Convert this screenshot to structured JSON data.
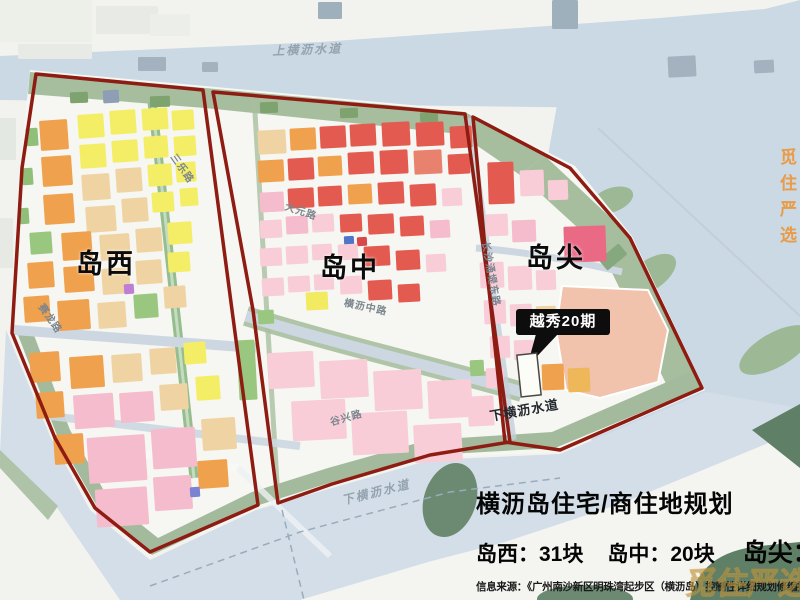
{
  "title_block": {
    "title": "横沥岛住宅/商住地规划",
    "stats": [
      "岛西：31块",
      "岛中：20块",
      "岛尖：3块"
    ],
    "source": "信息来源：《广州南沙新区明珠湾起步区（横沥岛）控制性详细规划修编批前公示》"
  },
  "callout": {
    "label": "越秀20期"
  },
  "watermarks": {
    "right": "觅住严选",
    "corner": "觅住严选"
  },
  "map_labels": [
    {
      "t": "岛西",
      "x": 76,
      "y": 242,
      "r": 0,
      "cls": "region"
    },
    {
      "t": "岛中",
      "x": 320,
      "y": 246,
      "r": 0,
      "cls": "region"
    },
    {
      "t": "岛尖",
      "x": 526,
      "y": 236,
      "r": 0,
      "cls": "region"
    },
    {
      "t": "上横沥水道",
      "x": 272,
      "y": 42,
      "r": -2,
      "cls": "water"
    },
    {
      "t": "下横沥水道",
      "x": 340,
      "y": 492,
      "r": -14,
      "cls": "water"
    },
    {
      "t": "下横沥水道",
      "x": 488,
      "y": 406,
      "r": -10,
      "cls": "water-dark"
    },
    {
      "t": "三乐路",
      "x": 180,
      "y": 150,
      "r": 55,
      "cls": "road"
    },
    {
      "t": "大元路",
      "x": 288,
      "y": 198,
      "r": 18,
      "cls": "road"
    },
    {
      "t": "横沥中路",
      "x": 346,
      "y": 294,
      "r": 12,
      "cls": "road"
    },
    {
      "t": "赛龙路",
      "x": 48,
      "y": 300,
      "r": 55,
      "cls": "road"
    },
    {
      "t": "谷兴路",
      "x": 328,
      "y": 414,
      "r": -16,
      "cls": "road"
    },
    {
      "t": "长沙涌堤东路",
      "x": 494,
      "y": 240,
      "r": 80,
      "cls": "road"
    }
  ],
  "boundary_color": "#8e1c12",
  "parcels": [
    [
      0,
      0,
      92,
      42,
      "#edefe9",
      0
    ],
    [
      96,
      6,
      62,
      28,
      "#e8ebe5",
      0
    ],
    [
      18,
      44,
      74,
      15,
      "#e8ebe5",
      0
    ],
    [
      150,
      14,
      40,
      22,
      "#eceee9",
      0
    ],
    [
      138,
      57,
      28,
      14,
      "#a4b2bf",
      0
    ],
    [
      202,
      62,
      16,
      10,
      "#a4b2bf",
      0
    ],
    [
      318,
      2,
      24,
      17,
      "#9fb0bd",
      0
    ],
    [
      552,
      0,
      26,
      29,
      "#9fb0bd",
      0
    ],
    [
      668,
      56,
      28,
      21,
      "#a4b2bf",
      -3
    ],
    [
      754,
      60,
      20,
      13,
      "#a4b2bf",
      -3
    ],
    [
      103,
      90,
      16,
      13,
      "#8e9fb5",
      -3
    ],
    [
      0,
      118,
      16,
      42,
      "#e4e8e2",
      0
    ],
    [
      0,
      218,
      13,
      50,
      "#e7eae4",
      0
    ],
    [
      70,
      92,
      18,
      11,
      "#7fa36f",
      -2
    ],
    [
      150,
      96,
      20,
      11,
      "#7fa36f",
      -2
    ],
    [
      260,
      102,
      18,
      11,
      "#7fa36f",
      -2
    ],
    [
      340,
      108,
      18,
      10,
      "#7fa36f",
      -2
    ],
    [
      420,
      112,
      18,
      10,
      "#7fa36f",
      -2
    ],
    [
      600,
      250,
      26,
      14,
      "#86a87e",
      -40
    ],
    [
      26,
      128,
      12,
      18,
      "#8fbf78",
      -4
    ],
    [
      22,
      168,
      11,
      17,
      "#8fbf78",
      -4
    ],
    [
      19,
      208,
      10,
      16,
      "#8fbf78",
      -4
    ],
    [
      30,
      232,
      22,
      22,
      "#9ac77f",
      -4
    ],
    [
      40,
      120,
      28,
      30,
      "#efa14d",
      -4
    ],
    [
      42,
      156,
      30,
      30,
      "#efa14d",
      -4
    ],
    [
      44,
      194,
      30,
      30,
      "#efa14d",
      -4
    ],
    [
      28,
      262,
      26,
      26,
      "#efa14d",
      -4
    ],
    [
      24,
      296,
      26,
      26,
      "#efa14d",
      -4
    ],
    [
      78,
      114,
      26,
      24,
      "#f4ee66",
      -4
    ],
    [
      110,
      110,
      26,
      24,
      "#f4ee66",
      -4
    ],
    [
      142,
      108,
      26,
      22,
      "#f4ee66",
      -4
    ],
    [
      172,
      110,
      22,
      20,
      "#f4ee66",
      -4
    ],
    [
      80,
      144,
      26,
      24,
      "#f4ee66",
      -4
    ],
    [
      112,
      140,
      26,
      22,
      "#f4ee66",
      -4
    ],
    [
      144,
      136,
      24,
      22,
      "#f4ee66",
      -4
    ],
    [
      174,
      136,
      22,
      20,
      "#f4ee66",
      -4
    ],
    [
      148,
      164,
      24,
      22,
      "#f4ee66",
      -4
    ],
    [
      176,
      162,
      20,
      20,
      "#f4ee66",
      -4
    ],
    [
      152,
      192,
      22,
      20,
      "#f4ee66",
      -4
    ],
    [
      180,
      188,
      18,
      18,
      "#f4ee66",
      -4
    ],
    [
      82,
      174,
      28,
      26,
      "#f0d3a2",
      -4
    ],
    [
      116,
      168,
      26,
      24,
      "#f0d3a2",
      -4
    ],
    [
      86,
      206,
      30,
      26,
      "#f0d3a2",
      -4
    ],
    [
      122,
      198,
      26,
      24,
      "#f0d3a2",
      -4
    ],
    [
      62,
      232,
      30,
      28,
      "#efa14d",
      -4
    ],
    [
      100,
      234,
      30,
      26,
      "#f0d3a2",
      -4
    ],
    [
      136,
      228,
      26,
      24,
      "#f0d3a2",
      -4
    ],
    [
      168,
      222,
      24,
      22,
      "#f4ee66",
      -4
    ],
    [
      64,
      266,
      30,
      26,
      "#efa14d",
      -4
    ],
    [
      102,
      268,
      28,
      26,
      "#f0d3a2",
      -4
    ],
    [
      136,
      260,
      26,
      24,
      "#f0d3a2",
      -4
    ],
    [
      168,
      252,
      22,
      20,
      "#f4ee66",
      -4
    ],
    [
      58,
      300,
      32,
      30,
      "#efa14d",
      -4
    ],
    [
      98,
      302,
      28,
      26,
      "#f0d3a2",
      -4
    ],
    [
      134,
      294,
      24,
      24,
      "#9ac77f",
      -4
    ],
    [
      124,
      284,
      10,
      10,
      "#bd7fd6",
      -4
    ],
    [
      164,
      286,
      22,
      22,
      "#f0d3a2",
      -4
    ],
    [
      30,
      352,
      30,
      30,
      "#efa14d",
      -4
    ],
    [
      70,
      356,
      34,
      32,
      "#efa14d",
      -4
    ],
    [
      112,
      354,
      30,
      28,
      "#f0d3a2",
      -4
    ],
    [
      150,
      348,
      26,
      26,
      "#f0d3a2",
      -4
    ],
    [
      184,
      342,
      22,
      22,
      "#f4ee66",
      -4
    ],
    [
      36,
      392,
      28,
      26,
      "#efa14d",
      -4
    ],
    [
      74,
      394,
      40,
      34,
      "#f5bccd",
      -4
    ],
    [
      120,
      392,
      34,
      30,
      "#f5bccd",
      -4
    ],
    [
      160,
      384,
      28,
      26,
      "#f0d3a2",
      -4
    ],
    [
      196,
      376,
      24,
      24,
      "#f4ee66",
      -4
    ],
    [
      88,
      436,
      58,
      46,
      "#f5bccd",
      -4
    ],
    [
      152,
      428,
      44,
      40,
      "#f5bccd",
      -4
    ],
    [
      202,
      418,
      34,
      32,
      "#f0d3a2",
      -4
    ],
    [
      54,
      434,
      30,
      30,
      "#efa14d",
      -4
    ],
    [
      96,
      488,
      52,
      38,
      "#f5bccd",
      -4
    ],
    [
      154,
      476,
      38,
      34,
      "#f5bccd",
      -4
    ],
    [
      198,
      460,
      30,
      28,
      "#efa14d",
      -4
    ],
    [
      190,
      487,
      10,
      10,
      "#7b83d2",
      -4
    ],
    [
      238,
      340,
      18,
      60,
      "#9ac77f",
      -3
    ],
    [
      258,
      130,
      28,
      24,
      "#f0d3a2",
      -3
    ],
    [
      290,
      128,
      26,
      22,
      "#efa14d",
      -3
    ],
    [
      320,
      126,
      26,
      22,
      "#e25a50",
      -3
    ],
    [
      350,
      124,
      26,
      22,
      "#e25a50",
      -3
    ],
    [
      382,
      122,
      28,
      24,
      "#e25a50",
      -3
    ],
    [
      416,
      122,
      28,
      24,
      "#e25a50",
      -3
    ],
    [
      450,
      126,
      22,
      22,
      "#e25a50",
      -3
    ],
    [
      258,
      160,
      26,
      22,
      "#efa14d",
      -3
    ],
    [
      288,
      158,
      26,
      22,
      "#e25a50",
      -3
    ],
    [
      318,
      156,
      24,
      20,
      "#efa14d",
      -3
    ],
    [
      348,
      152,
      26,
      22,
      "#e25a50",
      -3
    ],
    [
      380,
      150,
      28,
      24,
      "#e25a50",
      -3
    ],
    [
      414,
      150,
      28,
      24,
      "#e8826e",
      -3
    ],
    [
      448,
      154,
      22,
      20,
      "#e25a50",
      -3
    ],
    [
      260,
      192,
      24,
      20,
      "#f5bccd",
      -3
    ],
    [
      288,
      188,
      26,
      20,
      "#e25a50",
      -3
    ],
    [
      318,
      186,
      24,
      20,
      "#e25a50",
      -3
    ],
    [
      348,
      184,
      24,
      20,
      "#efa14d",
      -3
    ],
    [
      378,
      182,
      26,
      22,
      "#e25a50",
      -3
    ],
    [
      410,
      184,
      26,
      22,
      "#e25a50",
      -3
    ],
    [
      442,
      188,
      20,
      18,
      "#f8cdd8",
      -3
    ],
    [
      260,
      220,
      22,
      18,
      "#f8cdd8",
      -3
    ],
    [
      286,
      216,
      22,
      18,
      "#f5bccd",
      -3
    ],
    [
      312,
      214,
      22,
      18,
      "#f8cdd8",
      -3
    ],
    [
      340,
      214,
      22,
      18,
      "#e25a50",
      -3
    ],
    [
      368,
      214,
      26,
      20,
      "#e25a50",
      -3
    ],
    [
      400,
      216,
      24,
      20,
      "#e25a50",
      -3
    ],
    [
      430,
      220,
      20,
      18,
      "#f5bccd",
      -3
    ],
    [
      344,
      236,
      10,
      9,
      "#4f74c8",
      -3
    ],
    [
      357,
      237,
      10,
      9,
      "#d84848",
      -3
    ],
    [
      260,
      248,
      22,
      18,
      "#f8cdd8",
      -3
    ],
    [
      286,
      246,
      22,
      18,
      "#f8cdd8",
      -3
    ],
    [
      312,
      244,
      20,
      16,
      "#f8cdd8",
      -3
    ],
    [
      338,
      244,
      20,
      16,
      "#f8cdd8",
      -3
    ],
    [
      364,
      246,
      26,
      20,
      "#e25a50",
      -3
    ],
    [
      396,
      250,
      24,
      20,
      "#e25a50",
      -3
    ],
    [
      426,
      254,
      20,
      18,
      "#f8cdd8",
      -3
    ],
    [
      262,
      278,
      22,
      18,
      "#f8cdd8",
      -3
    ],
    [
      288,
      276,
      22,
      16,
      "#f8cdd8",
      -3
    ],
    [
      314,
      274,
      20,
      16,
      "#f8cdd8",
      -3
    ],
    [
      306,
      292,
      22,
      18,
      "#f2ea60",
      -3
    ],
    [
      340,
      276,
      22,
      18,
      "#f8cdd8",
      -3
    ],
    [
      368,
      280,
      24,
      20,
      "#e25a50",
      -3
    ],
    [
      398,
      284,
      22,
      18,
      "#e25a50",
      -3
    ],
    [
      268,
      352,
      46,
      36,
      "#f8cdd8",
      -3
    ],
    [
      320,
      360,
      48,
      38,
      "#f8cdd8",
      -3
    ],
    [
      374,
      370,
      48,
      40,
      "#f8cdd8",
      -3
    ],
    [
      428,
      380,
      44,
      38,
      "#f8cdd8",
      -3
    ],
    [
      292,
      400,
      54,
      40,
      "#f8cdd8",
      -3
    ],
    [
      352,
      412,
      56,
      42,
      "#f8cdd8",
      -3
    ],
    [
      414,
      424,
      48,
      38,
      "#f8cdd8",
      -3
    ],
    [
      468,
      396,
      26,
      30,
      "#f8cdd8",
      -3
    ],
    [
      258,
      310,
      16,
      14,
      "#9ac77f",
      -3
    ],
    [
      470,
      360,
      14,
      16,
      "#9ac77f",
      -3
    ],
    [
      488,
      162,
      26,
      42,
      "#e25a50",
      -2
    ],
    [
      520,
      170,
      24,
      26,
      "#f8cdd8",
      -2
    ],
    [
      548,
      180,
      20,
      20,
      "#f8cdd8",
      -2
    ],
    [
      486,
      214,
      22,
      22,
      "#f8cdd8",
      -2
    ],
    [
      512,
      220,
      24,
      22,
      "#f5bccd",
      -2
    ],
    [
      564,
      226,
      42,
      36,
      "#ea6a86",
      -2
    ],
    [
      480,
      262,
      24,
      26,
      "#f8cdd8",
      -2
    ],
    [
      508,
      266,
      24,
      24,
      "#f8cdd8",
      -2
    ],
    [
      536,
      270,
      20,
      20,
      "#f8cdd8",
      -2
    ],
    [
      484,
      300,
      22,
      24,
      "#f8cdd8",
      -2
    ],
    [
      510,
      304,
      22,
      22,
      "#f8cdd8",
      -2
    ],
    [
      536,
      306,
      20,
      20,
      "#f0d3a2",
      -2
    ],
    [
      490,
      336,
      20,
      22,
      "#f8cdd8",
      -2
    ],
    [
      514,
      340,
      20,
      20,
      "#f8cdd8",
      -2
    ],
    [
      486,
      368,
      18,
      20,
      "#f8cdd8",
      -2
    ],
    [
      542,
      364,
      22,
      26,
      "#efa14d",
      -2
    ],
    [
      568,
      368,
      22,
      24,
      "#eeb85a",
      -2
    ]
  ]
}
